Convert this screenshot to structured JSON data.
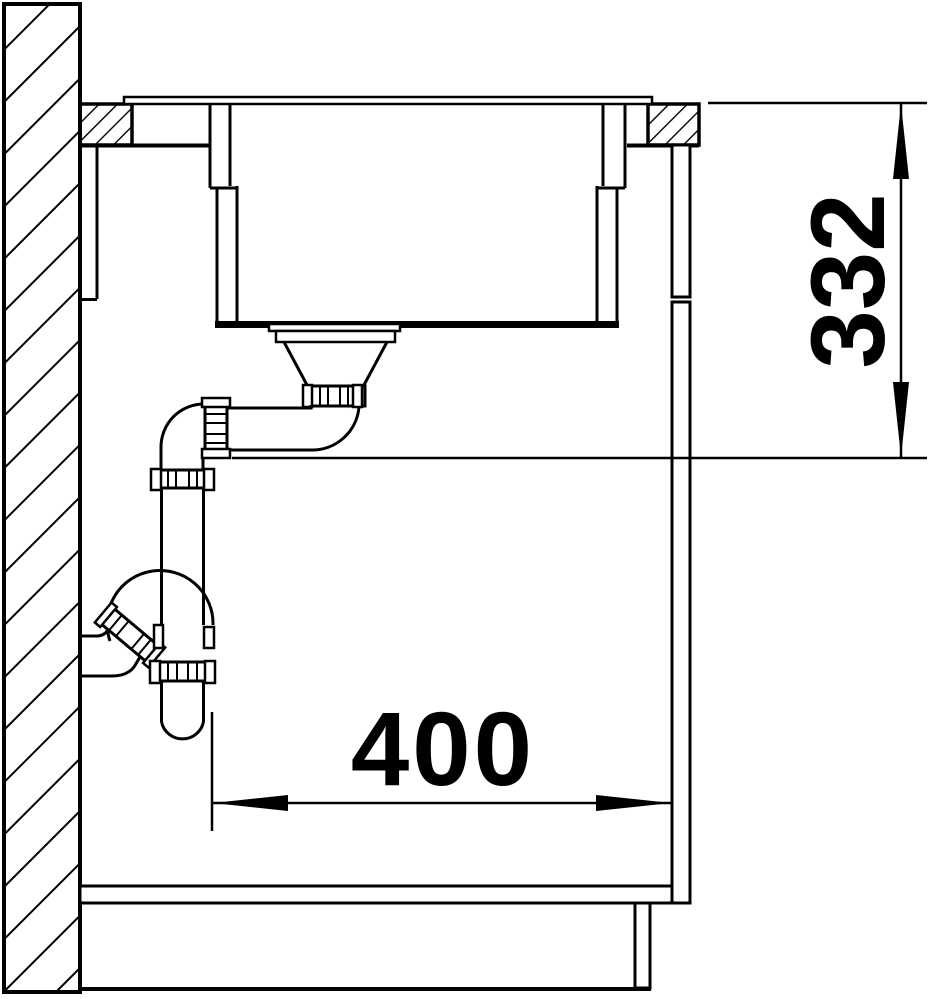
{
  "diagram": {
    "type": "technical-drawing",
    "subject": "kitchen sink installation cross-section side view with drain trap",
    "dimensions": {
      "vertical": {
        "value": "332",
        "description": "height from countertop top to drain outlet line"
      },
      "horizontal": {
        "value": "400",
        "description": "depth from trap to cabinet side panel"
      }
    },
    "colors": {
      "line": "#000000",
      "background": "#ffffff"
    }
  }
}
